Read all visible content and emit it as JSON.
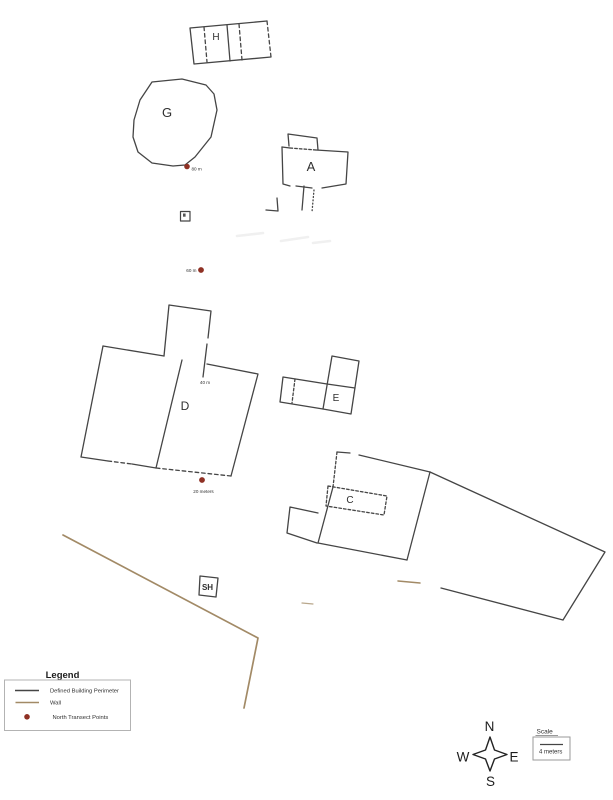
{
  "colors": {
    "building_outline": "#454545",
    "wall": "#a28a66",
    "transect_point": "#8f3124",
    "label": "#2f2f2f",
    "legend_border": "#b3b3b3",
    "scale_border": "#9a9a9a"
  },
  "buildings": {
    "h": "H",
    "g": "G",
    "a": "A",
    "d": "D",
    "e": "E",
    "c": "C",
    "sh": "SH"
  },
  "transect_points": {
    "p80": "80 m",
    "p60": "60 m",
    "p40": "40 m",
    "p20": "20 meters"
  },
  "legend": {
    "title": "Legend",
    "items": [
      {
        "label": "Defined Building Perimeter"
      },
      {
        "label": "Wall"
      },
      {
        "label": "North Transect Points"
      }
    ]
  },
  "compass": {
    "n": "N",
    "w": "W",
    "e": "E",
    "s": "S"
  },
  "scale_box": {
    "title": "Scale",
    "value": "4 meters"
  }
}
